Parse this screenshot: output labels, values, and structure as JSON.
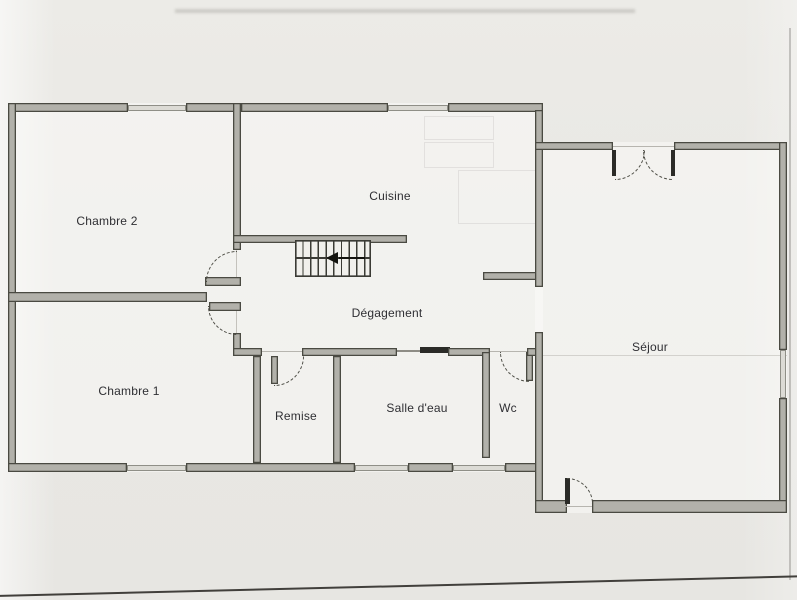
{
  "plan": {
    "rooms": {
      "chambre_2": "Chambre 2",
      "chambre_1": "Chambre 1",
      "cuisine": "Cuisine",
      "degagement": "Dégagement",
      "remise": "Remise",
      "salle_deau": "Salle d'eau",
      "wc": "Wc",
      "sejour": "Séjour"
    },
    "icons": {
      "stairs_direction": "arrow-left"
    },
    "colors": {
      "paper": "#e9e8e4",
      "wall_fill": "#b2b1aa",
      "wall_edge": "#4a4a42",
      "window_fill": "#dcdbd5",
      "door_arc": "#4e4e46",
      "text": "#2f2f33"
    }
  }
}
